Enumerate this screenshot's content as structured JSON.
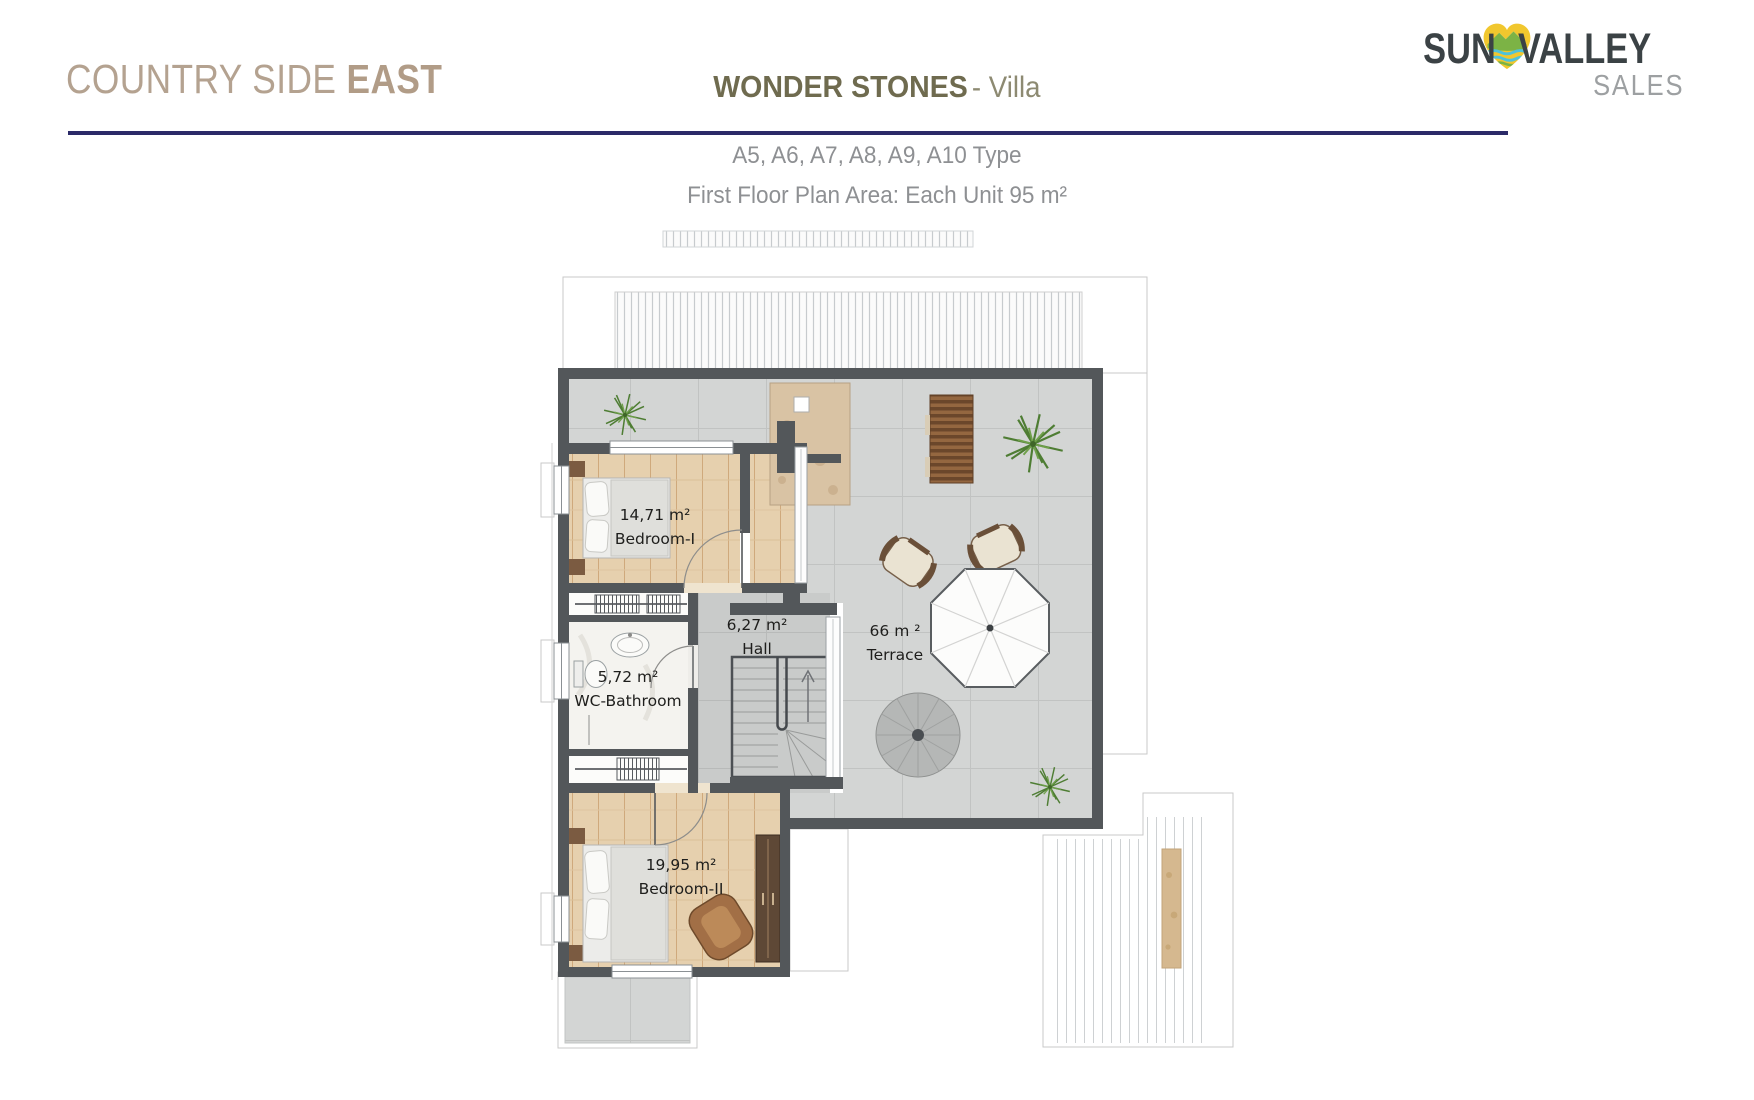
{
  "header": {
    "brand_light": "COUNTRY SIDE",
    "brand_bold": "EAST",
    "title_bold": "WONDER STONES",
    "title_light": "- Villa",
    "subtitle_type": "A5, A6, A7, A8, A9, A10 Type",
    "subtitle_area": "First Floor Plan Area: Each Unit 95 m²"
  },
  "logo": {
    "sun": "SUN",
    "valley": "VALLEY",
    "sales": "SALES",
    "heart_icon": "heart-mountain-icon"
  },
  "plan": {
    "rooms": {
      "bedroom1": {
        "area": "14,71 m²",
        "name": "Bedroom-I"
      },
      "hall": {
        "area": "6,27 m²",
        "name": "Hall"
      },
      "wc_bathroom": {
        "area": "5,72 m²",
        "name": "WC-Bathroom"
      },
      "terrace": {
        "area": "66 m ²",
        "name": "Terrace"
      },
      "bedroom2": {
        "area": "19,95 m²",
        "name": "Bedroom-II"
      }
    }
  },
  "colors": {
    "accent_rule": "#2b2a68",
    "brand": "#b4a290",
    "title": "#6f6b4f",
    "subtitle": "#8e9093",
    "logo_dark": "#3b4245",
    "logo_gray": "#9da0a2",
    "logo_yellow": "#f1c72e",
    "wall": "#53575a",
    "wood_floor": "#e6d0ae",
    "tile_floor": "#d3d5d4"
  }
}
